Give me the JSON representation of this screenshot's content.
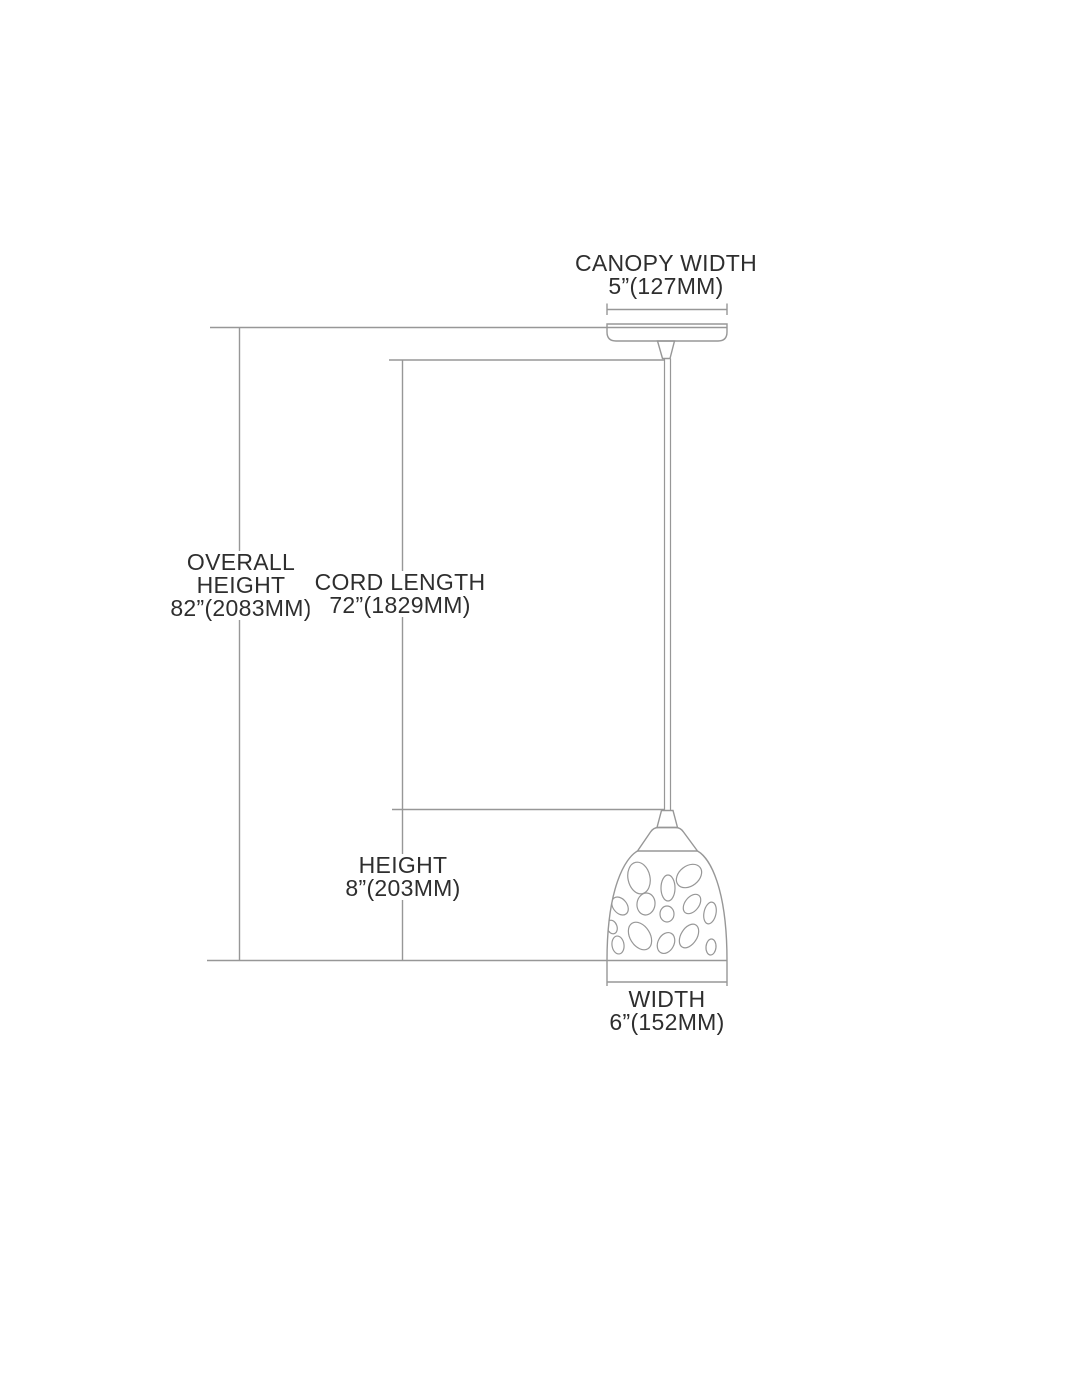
{
  "diagram_type": "pendant-light-dimension-diagram",
  "colors": {
    "background": "#ffffff",
    "line": "#979797",
    "text": "#2e2e2e"
  },
  "labels": {
    "canopy_width": {
      "name": "CANOPY WIDTH",
      "value": "5”(127MM)"
    },
    "overall_height": {
      "name_line1": "OVERALL",
      "name_line2": "HEIGHT",
      "value": "82”(2083MM)"
    },
    "cord_length": {
      "name": "CORD LENGTH",
      "value": "72”(1829MM)"
    },
    "height": {
      "name": "HEIGHT",
      "value": "8”(203MM)"
    },
    "width": {
      "name": "WIDTH",
      "value": "6”(152MM)"
    }
  }
}
